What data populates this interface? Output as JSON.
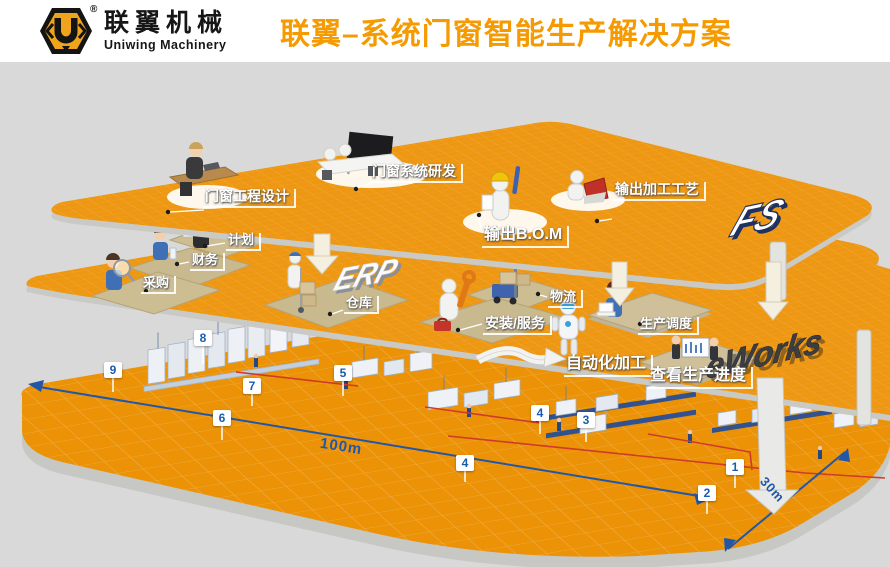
{
  "header": {
    "logo": {
      "mark": "U",
      "registered": "®",
      "brand_cn": "联翼机械",
      "brand_en": "Uniwing Machinery"
    },
    "title": "联翼–系统门窗智能生产解决方案"
  },
  "layers": {
    "design": {
      "system_label": "FS",
      "stations": [
        "门窗工程设计",
        "门窗系统研发",
        "输出B.O.M",
        "输出加工工艺"
      ]
    },
    "erp": {
      "system_label": "ERP",
      "stations": [
        "计划",
        "财务",
        "采购",
        "仓库",
        "物流",
        "安装/服务"
      ]
    },
    "eworks": {
      "system_label": "eWorks",
      "stations": [
        "生产调度",
        "自动化加工",
        "查看生产进度"
      ]
    }
  },
  "factory": {
    "markers": [
      "1",
      "2",
      "3",
      "4",
      "4",
      "5",
      "6",
      "7",
      "8",
      "9"
    ],
    "dimensions": {
      "length": "100m",
      "width": "30m"
    }
  },
  "icons": {
    "logo-hexagon": "brand hexagon badge",
    "down-arrow": "flow arrow between layers",
    "curved-arrow": "flow arrow to automation",
    "big-curved-arrow": "flow arrow to factory floor",
    "dimension-line": "blue measuring line",
    "route-line": "red production route"
  },
  "colors": {
    "accent_orange": "#F59A00",
    "layer_orange": "#EE9712",
    "logo_orange": "#F0A41C",
    "marker_blue": "#1B5BAD",
    "dimension_blue": "#2257A8",
    "route_red": "#D03A28",
    "background_gray": "#D9D9D9"
  }
}
